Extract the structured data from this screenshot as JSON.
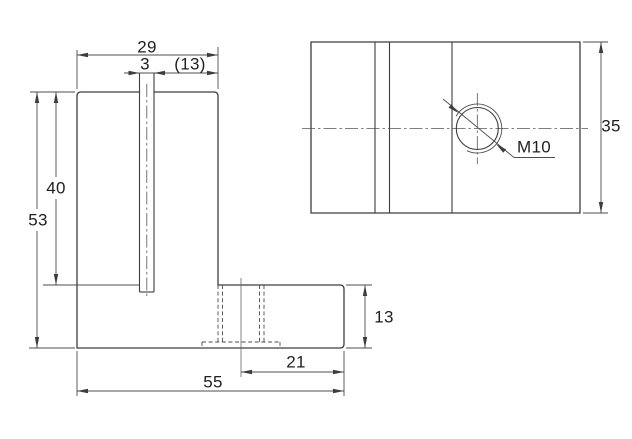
{
  "drawing": {
    "type": "engineering-drawing",
    "part": "L-bracket with open slot and M10 tapped hole, two orthographic views",
    "front_view": {
      "dimensions": {
        "plate_width": "29",
        "slot_width": "3",
        "slot_to_edge_ref": "(13)",
        "plate_height": "40",
        "total_height": "53",
        "base_height": "13",
        "hole_center_to_edge": "21",
        "total_width": "55"
      }
    },
    "top_view": {
      "dimensions": {
        "depth": "35"
      },
      "thread_callout": "M10"
    },
    "colors": {
      "line": "#3d3d3d",
      "dim_line": "#4c4c4c",
      "text": "#1f1f1f",
      "background": "#ffffff"
    }
  }
}
